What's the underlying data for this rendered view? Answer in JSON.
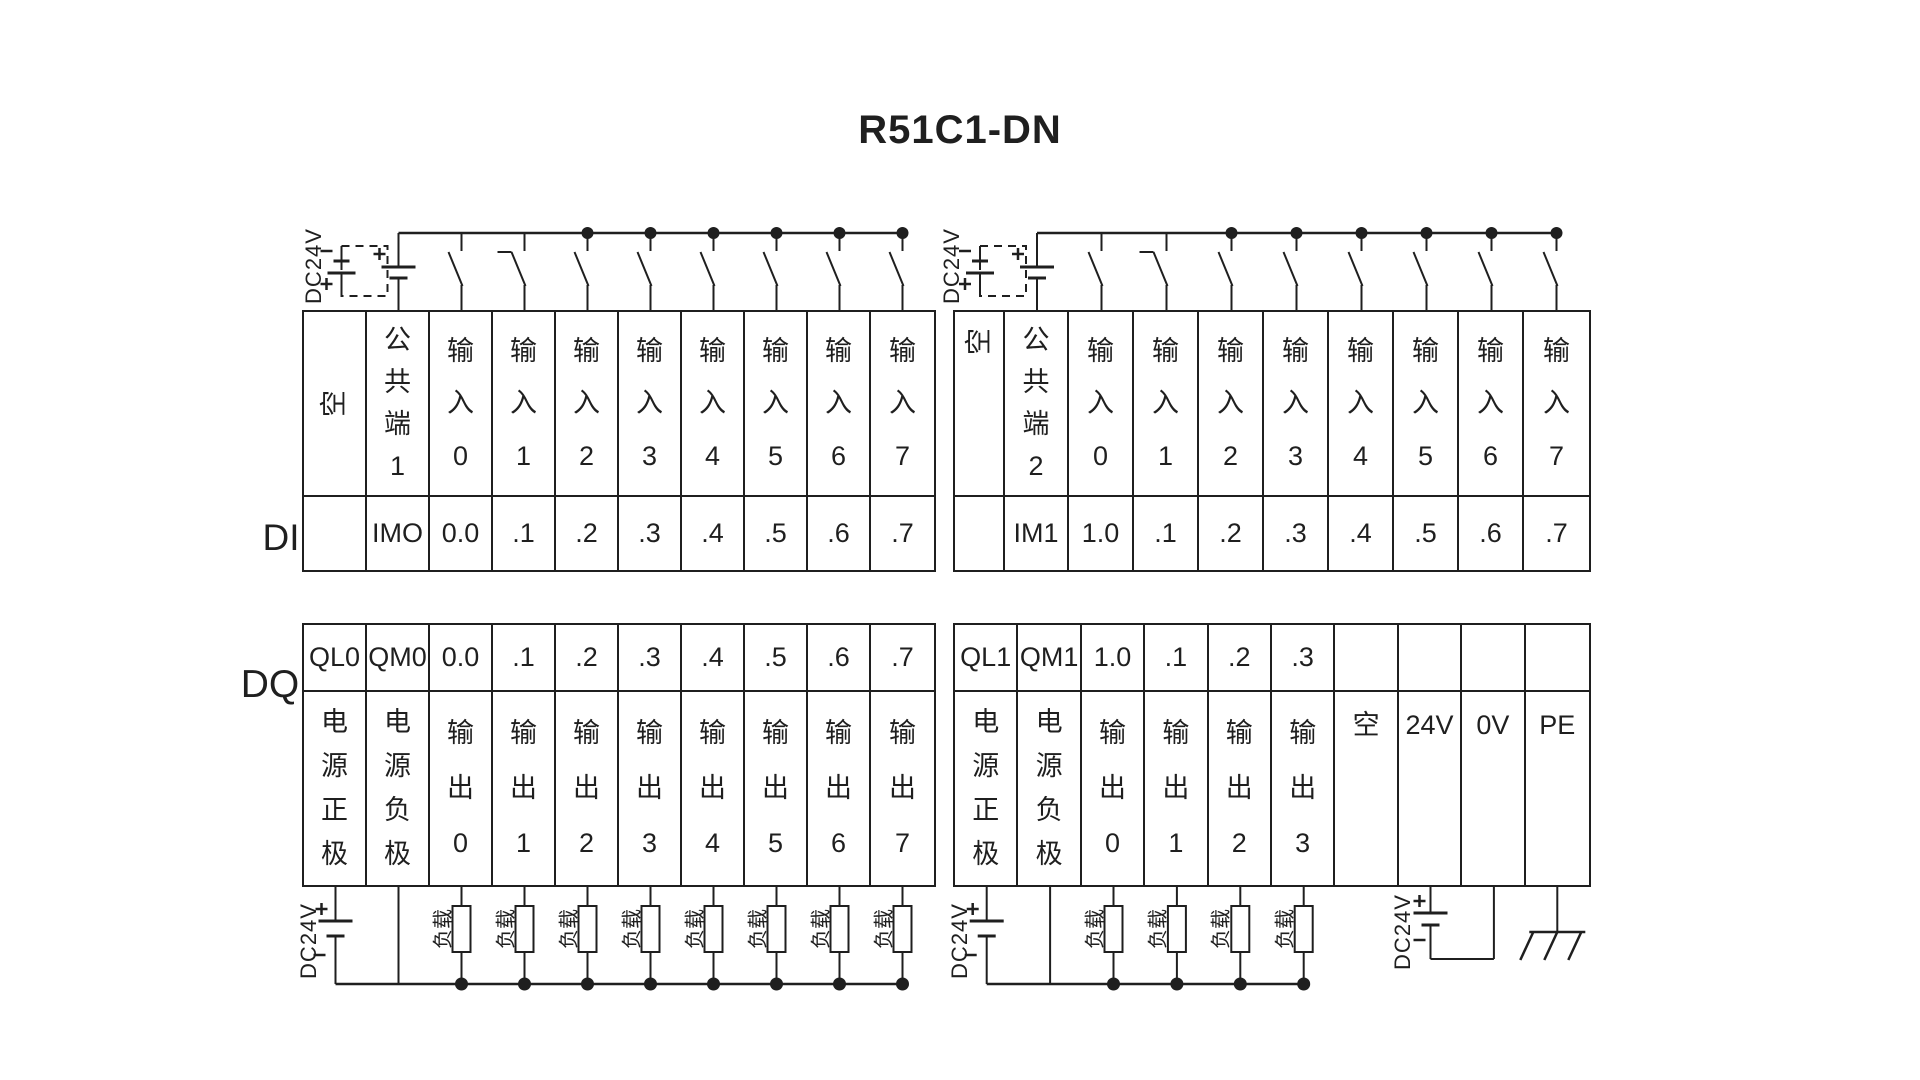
{
  "title": "R51C1-DN",
  "colors": {
    "ink": "#1f1f1f",
    "background": "#ffffff"
  },
  "sections": {
    "di_label": "DI",
    "dq_label": "DQ"
  },
  "power_source_label": "DC24V",
  "load_label": "负载",
  "polarity": {
    "plus": "+",
    "minus": "-"
  },
  "icons": [
    "battery-symbol",
    "optional-battery-dashed-box",
    "switch-contact",
    "junction-dot",
    "load-resistor",
    "ground-symbol"
  ],
  "tables": {
    "di_left": {
      "headers": [
        "空",
        "公共端1",
        "输入0",
        "输入1",
        "输入2",
        "输入3",
        "输入4",
        "输入5",
        "输入6",
        "输入7"
      ],
      "values": [
        "",
        "IMO",
        "0.0",
        ".1",
        ".2",
        ".3",
        ".4",
        ".5",
        ".6",
        ".7"
      ]
    },
    "di_right": {
      "headers": [
        "空",
        "公共端2",
        "输入0",
        "输入1",
        "输入2",
        "输入3",
        "输入4",
        "输入5",
        "输入6",
        "输入7"
      ],
      "values": [
        "",
        "IM1",
        "1.0",
        ".1",
        ".2",
        ".3",
        ".4",
        ".5",
        ".6",
        ".7"
      ]
    },
    "dq_left": {
      "values": [
        "QL0",
        "QM0",
        "0.0",
        ".1",
        ".2",
        ".3",
        ".4",
        ".5",
        ".6",
        ".7"
      ],
      "headers": [
        "电源正极",
        "电源负极",
        "输出0",
        "输出1",
        "输出2",
        "输出3",
        "输出4",
        "输出5",
        "输出6",
        "输出7"
      ]
    },
    "dq_right": {
      "values": [
        "QL1",
        "QM1",
        "1.0",
        ".1",
        ".2",
        ".3",
        "",
        "",
        "",
        ""
      ],
      "headers": [
        "电源正极",
        "电源负极",
        "输出0",
        "输出1",
        "输出2",
        "输出3",
        "空",
        "24V",
        "0V",
        "PE"
      ]
    }
  }
}
